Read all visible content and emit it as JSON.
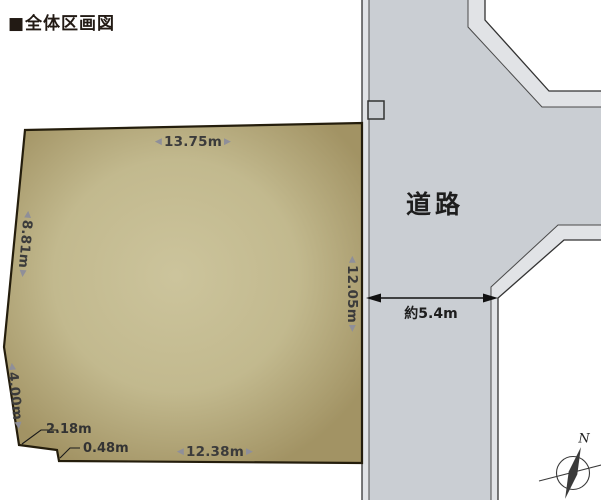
{
  "title": "■全体区画図",
  "ui": {
    "arrow_left": "◀",
    "arrow_right": "▶"
  },
  "parcel": {
    "dim_top": "13.75m",
    "dim_left_upper": "8.81m",
    "dim_left_lower": "4.00m",
    "dim_step_a": "2.18m",
    "dim_step_b": "0.48m",
    "dim_bottom": "12.38m",
    "dim_right": "12.05m",
    "fill_center": "#c9c098",
    "fill_edge": "#a29364"
  },
  "road": {
    "label": "道路",
    "width_label": "約5.4m",
    "fill": "#caced3",
    "stripe": "#e1e3e6"
  },
  "compass": {
    "north": "N"
  }
}
